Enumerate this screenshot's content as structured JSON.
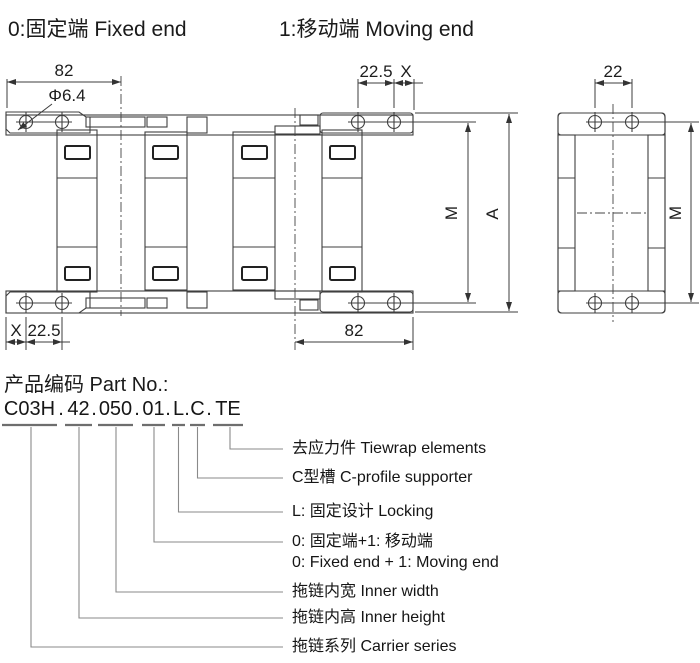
{
  "header": {
    "fixed_end": "0:固定端 Fixed end",
    "moving_end": "1:移动端 Moving end"
  },
  "drawing": {
    "dim_width_top": "82",
    "dim_hole_dia": "Φ6.4",
    "dim_pitch_top": "22.5",
    "dim_x_top": "X",
    "dim_x_bottom": "X",
    "dim_pitch_bottom": "22.5",
    "dim_width_bottom": "82",
    "dim_inner_height": "M",
    "dim_outer_height": "A",
    "side_hole_pitch": "22",
    "side_inner_height": "M"
  },
  "part_number": {
    "title": "产品编码 Part No.:",
    "separator": ".",
    "code_full": "C03H.42.050.01.L.C.TE",
    "segments": [
      {
        "code": "C03H",
        "label": "拖链系列 Carrier series"
      },
      {
        "code": "42",
        "label": "拖链内高 Inner height"
      },
      {
        "code": "050",
        "label": "拖链内宽 Inner width"
      },
      {
        "code": "01",
        "label": "0: 固定端+1: 移动端",
        "label_en": "0: Fixed end + 1: Moving end"
      },
      {
        "code": "L",
        "label": "L: 固定设计 Locking"
      },
      {
        "code": "C",
        "label": "C型槽 C-profile supporter"
      },
      {
        "code": "TE",
        "label": "去应力件 Tiewrap elements"
      }
    ]
  }
}
